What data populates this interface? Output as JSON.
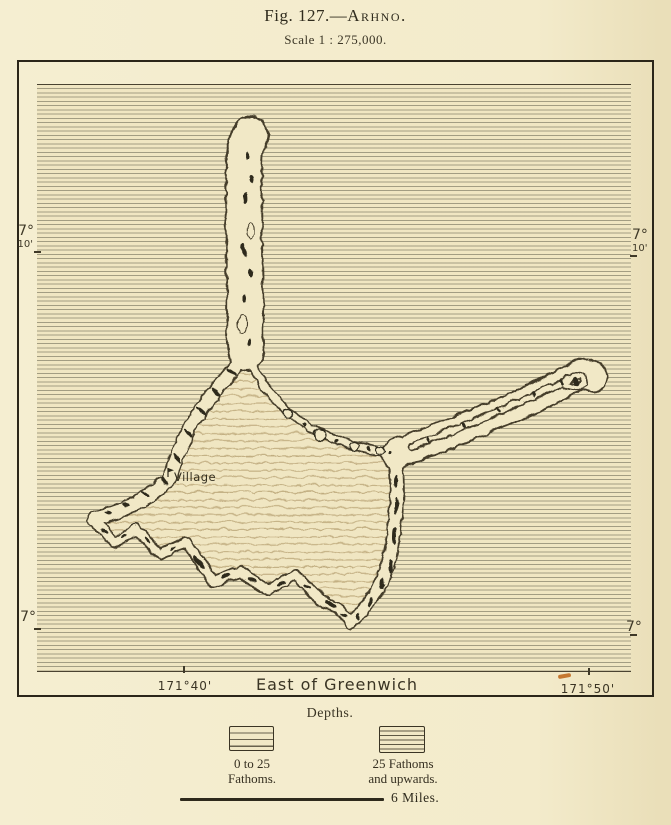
{
  "title": {
    "figure_label": "Fig. 127.—",
    "map_name": "Arhno.",
    "scale_note": "Scale 1 : 275,000."
  },
  "graticule": {
    "lat_upper_left": {
      "deg": "7°",
      "min": "10'"
    },
    "lat_upper_right": {
      "deg": "7°",
      "min": "10'"
    },
    "lat_lower_left": {
      "deg": "7°"
    },
    "lat_lower_right": {
      "deg": "7°"
    },
    "lon_left": "171°40'",
    "lon_right": "171°50'",
    "meridian_note": "East of Greenwich"
  },
  "map_labels": {
    "village": "Village"
  },
  "legend": {
    "heading": "Depths.",
    "items": [
      {
        "line1": "0 to 25",
        "line2": "Fathoms."
      },
      {
        "line1": "25 Fathoms",
        "line2": "and upwards."
      }
    ],
    "scale_bar_label": "6 Miles."
  },
  "colors": {
    "paper": "#f3ebcb",
    "ink": "#3a3424",
    "ocean_hatch": "#6f6d5c",
    "lagoon_hatch": "#a8915f",
    "accent_mark": "#c06a1e"
  }
}
